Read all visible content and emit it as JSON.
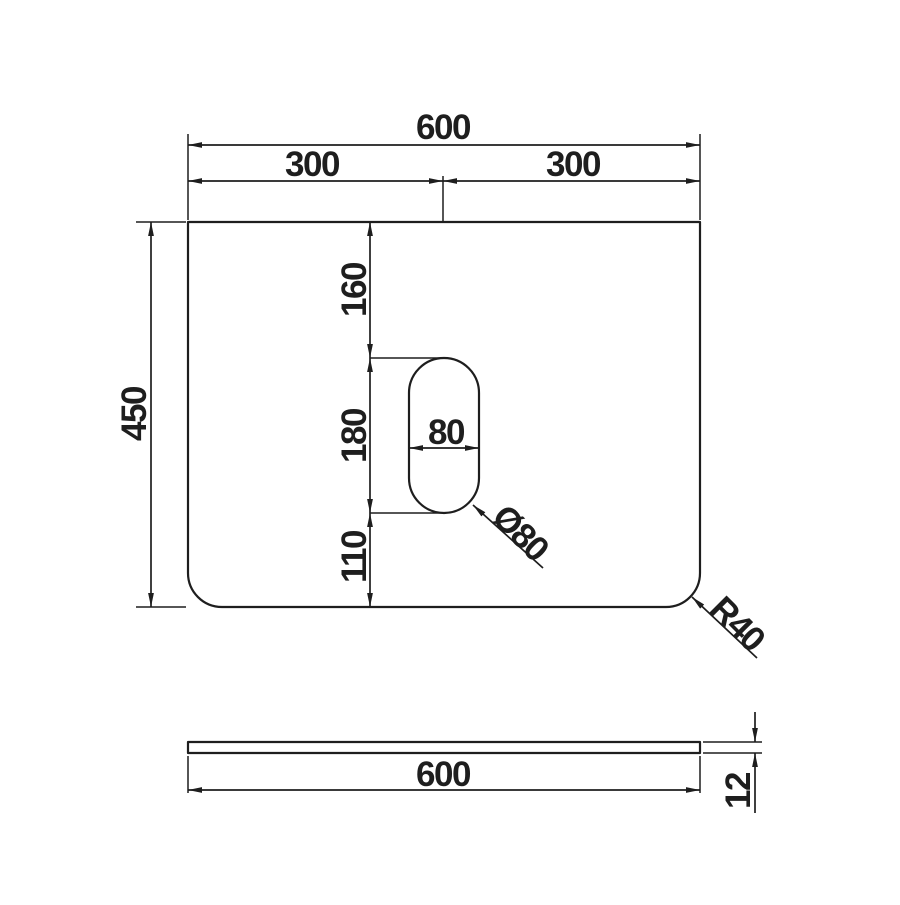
{
  "page": {
    "background": "#ffffff",
    "line_color": "#1e1e1e"
  },
  "views": {
    "top_view": {
      "name": "panel top view",
      "dims": {
        "overall_width": "600",
        "left_half": "300",
        "right_half": "300",
        "overall_height": "450",
        "top_edge_to_slot": "160",
        "slot_length": "180",
        "slot_to_bottom_edge": "110",
        "slot_width": "80",
        "slot_end_diameter": "Ø80",
        "corner_radius": "R40"
      }
    },
    "side_view": {
      "name": "panel side profile",
      "dims": {
        "overall_width": "600",
        "thickness": "12"
      }
    }
  }
}
